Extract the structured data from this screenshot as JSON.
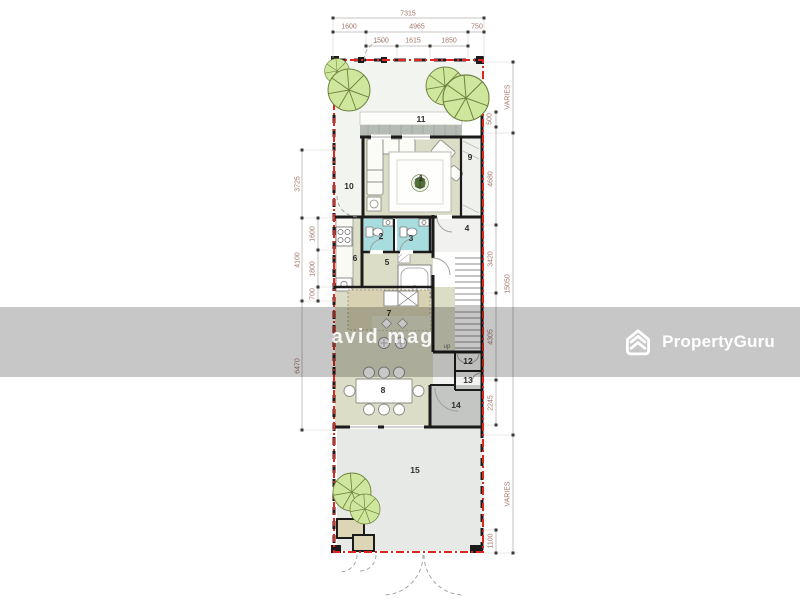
{
  "colors": {
    "boundary_red": "#e0241e",
    "bath_cyan": "#a8dde0",
    "floor_olive": "#dcddc7",
    "floor_gray": "#c3c6c3",
    "patio_gray": "#e7e9e6",
    "garden_tint": "#f2f4f0",
    "deck_gray": "#b6bbb6",
    "counter_tan": "#d8d2b2",
    "tree_green": "#cfe79c",
    "tree_line": "#6f8440",
    "wall_black": "#1b1b1b",
    "dim_text": "#a3766a",
    "watermark_gray": "#c7c7c7",
    "brand_white": "#ffffff"
  },
  "brand": {
    "name": "PropertyGuru",
    "watermark_text": "avid mag"
  },
  "floorplan": {
    "room_labels": [
      "1",
      "2",
      "3",
      "4",
      "5",
      "6",
      "7",
      "8",
      "9",
      "10",
      "11",
      "12",
      "13",
      "14",
      "15"
    ],
    "stairs_label": "up",
    "dimensions": {
      "top": {
        "total": "7315",
        "row2": [
          "1600",
          "4965",
          "750"
        ],
        "row3": [
          "1500",
          "1615",
          "1850"
        ]
      },
      "left": {
        "outer": [
          "3725",
          "4100",
          "6470"
        ],
        "inner": [
          "1600",
          "1800",
          "700"
        ]
      },
      "right": {
        "inner": [
          "500",
          "4680",
          "3420",
          "4305",
          "2245",
          "1100"
        ],
        "outer": [
          "VARIES",
          "15050",
          "VARIES"
        ]
      }
    }
  }
}
